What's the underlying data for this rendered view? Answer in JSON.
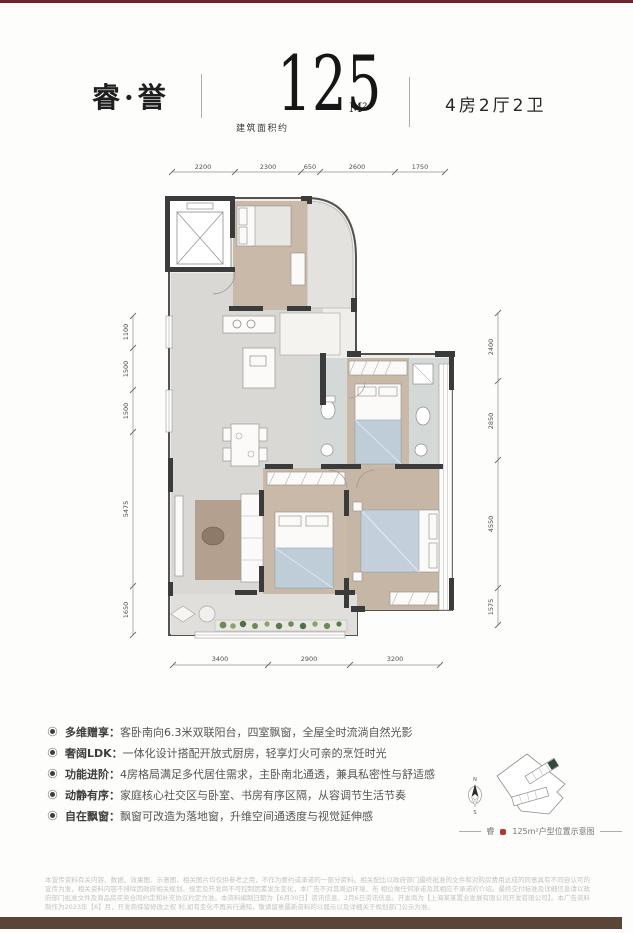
{
  "header": {
    "project_name": "睿·誉",
    "area_prefix": "建筑面积约",
    "area_value": "125",
    "area_unit": "M²",
    "layout": "4房2厅2卫"
  },
  "floorplan": {
    "dims_top": [
      "2200",
      "2300",
      "650",
      "2600",
      "1750"
    ],
    "dims_left": [
      "1100",
      "1500",
      "1500",
      "5475",
      "1650"
    ],
    "dims_right": [
      "2400",
      "2850",
      "4550",
      "1575"
    ],
    "dims_bottom": [
      "3400",
      "2900",
      "3200"
    ]
  },
  "features": [
    {
      "label": "多维赠享：",
      "text": "客卧南向6.3米双联阳台，四室飘窗，全屋全时流淌自然光影"
    },
    {
      "label": "奢阔LDK：",
      "text": "一体化设计搭配开放式厨房，轻享灯火可亲的烹饪时光"
    },
    {
      "label": "功能进阶：",
      "text": "4房格局满足多代居住需求，主卧南北通透，兼具私密性与舒适感"
    },
    {
      "label": "动静有序：",
      "text": "家庭核心社交区与卧室、书房有序区隔，从容调节生活节奏"
    },
    {
      "label": "自在飘窗：",
      "text": "飘窗可改造为落地窗，升维空间通透度与视觉延伸感"
    }
  ],
  "siteplan": {
    "compass_north": "N",
    "compass_south": "S",
    "caption_prefix": "睿",
    "caption_suffix": "125m²户型位置示意图"
  },
  "disclaimer": {
    "line1": "本宣传资料有关内容、数据、效果图、示意图、相关图片均仅供参考之用，不作为要约或承诺的一部分资料。相关配比以政府部门最终批准的文件和对购房费用达成的同意具有不同自认可的宣传为准，相关资料内容不排除因政府相关规划、规定及开发商不可控制因素发生变化，本广告不对其周边环境、布",
    "line2": "相位做任何承诺及其相应不承诺的介绍。最终交付标准及详细信息请以政府部门批准文件及商品房买卖合同约定和补充协议约定为准。本资料编制日期为【6月30日】资讯信息、2月6日资讯信息。开发商为【上海某某置业发展有限公司开发有限公司】。本广告资料制作为2023年【6】月，开发商保留修改之权",
    "line3": "利,如有变化不再另行通知，敬请留意最新资料的以届示以及详细关于规划部门公示为准。"
  },
  "colors": {
    "brand_red": "#6e2430",
    "footer_brown": "#5b4536",
    "wall_dark": "#3b3b3b",
    "wood_floor": "#c9b9a9",
    "gray_floor": "#d9d8d4",
    "bath_floor": "#d4d9d7",
    "blanket_blue": "#bfcdd9",
    "plant_green": "#6d8a57",
    "site_highlight": "#31493f"
  }
}
